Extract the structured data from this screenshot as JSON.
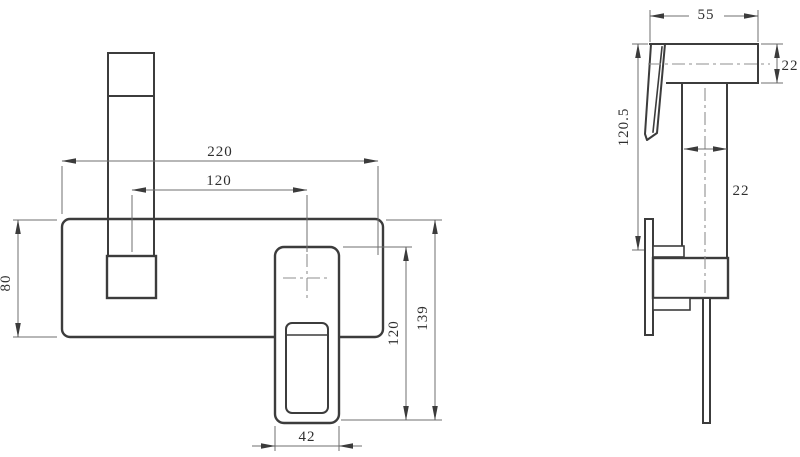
{
  "drawing": {
    "description": "Two-view orthographic dimension drawing of a wall-mounted square mixer faucet",
    "views": [
      {
        "id": "front",
        "name": "front elevation"
      },
      {
        "id": "side",
        "name": "side elevation"
      }
    ]
  },
  "dimensions": {
    "front": {
      "overall_width": "220",
      "spout_to_handle_spacing": "120",
      "plate_height": "80",
      "handle_length": "120",
      "overall_height": "139",
      "handle_width": "42"
    },
    "side": {
      "spout_projection": "55",
      "spout_height": "22",
      "overall_height": "120.5",
      "body_width": "22"
    }
  },
  "colors": {
    "outline": "#3c3c3c",
    "dimension_line": "#6f6f6f",
    "arrow": "#3b3b3b",
    "text": "#2f2f2f",
    "centerline": "#8f8f8f",
    "background": "#ffffff"
  }
}
